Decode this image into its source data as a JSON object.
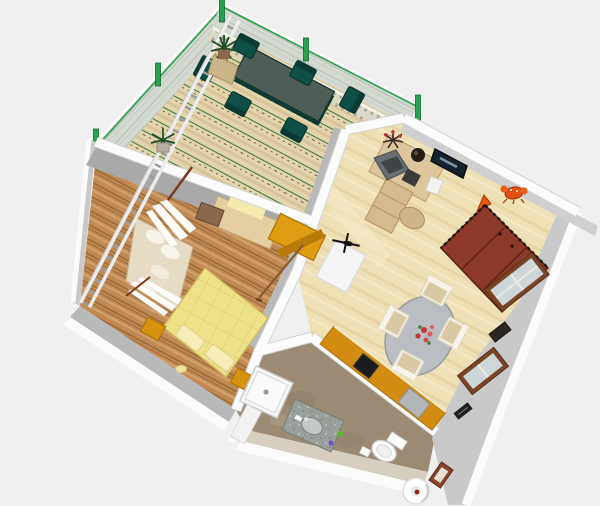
{
  "view": {
    "type": "aerial-3d-render",
    "description": "Bird's-eye 3D rendering of a furnished one-bedroom apartment with terrace, living room, bedroom, kitchen strip and bathroom"
  },
  "colors": {
    "background": "#f0f0f0",
    "wall_top": "#fbfbfb",
    "wall_edge": "#d2d2d2",
    "wall_face_light": "#c9c9c9",
    "wall_face_mid": "#b9b9b9",
    "wall_face_dark": "#a9a9a9",
    "wall_face_warm": "#d6cfc0",
    "terrace_deck": "#e4d4ab",
    "glass_railing": "#d4d9d1",
    "railing_post_green": "#28a24c",
    "balustrade": "#dcd9c8",
    "patio_table_top": "#4e5e57",
    "patio_table_edge": "#123831",
    "patio_chair": "#0e4f46",
    "living_floor": "#eee0b5",
    "bedroom_floor": "#c18a54",
    "bathroom_floor": "#9b8b74",
    "bed": "#ede289",
    "pillow": "#f6eeb6",
    "nightstand": "#d6930f",
    "dresser": "#e09c12",
    "wardrobe_red": "#8e3a28",
    "dining_table_gray": "#babdc1",
    "dining_chair_frame": "#f0ece0",
    "dining_chair_cushion": "#d9c9a2",
    "desk_wood": "#dcc79c",
    "monitor_gray": "#6a6f72",
    "tv_screen": "#16222e",
    "kitchen_counter": "#d28c12",
    "cooktop_black": "#1c1c1c",
    "appliance_gray": "#b2b6b8",
    "fridge_white": "#f5f5f5",
    "shower_white": "#fafafa",
    "sink_marble": "#9aa09c",
    "toilet_white": "#ffffff",
    "window_frame_brown": "#7a4526",
    "window_glass": "#cdd6d8",
    "vent_dark": "#2e2620",
    "toy_orange": "#e4590e",
    "crab_orange": "#e05010",
    "sofa_beige": "#e6dcc6",
    "curtain_white": "#fcfcf8",
    "curtain_rod": "#7a3a22",
    "ladder_rail": "#ececec",
    "ladder_rung": "#9c9c9c",
    "plant_green": "#1e4d22",
    "pedestal_tan": "#cbb689",
    "sideboard_tan": "#e3cf9f",
    "wall_yellow_patch": "#f4ecae",
    "broom_brown": "#8a5a30",
    "slipper_yellow": "#efe5a2",
    "picture_frame_brown": "#8a432a",
    "paper_roll_dot": "#8a2a20"
  },
  "rooms": [
    {
      "id": "terrace",
      "label": "terrace",
      "items": [
        "wood deck",
        "glass railing with green posts",
        "stone balustrade",
        "patio dining table",
        "six patio chairs",
        "two potted plants"
      ]
    },
    {
      "id": "living-room",
      "label": "living room",
      "items": [
        "red wardrobe",
        "oval dining table with flower centerpiece",
        "four upholstered chairs",
        "corner desk with monitor and keyboard",
        "wall tv",
        "toy cone",
        "toy crab",
        "fridge with toy helicopter"
      ]
    },
    {
      "id": "bedroom",
      "label": "bedroom",
      "items": [
        "double bed with pillows",
        "two nightstands",
        "daybed sofa with cushions",
        "curtains",
        "orange dresser",
        "broom",
        "slipper"
      ]
    },
    {
      "id": "kitchen",
      "label": "kitchen strip",
      "items": [
        "wood counter",
        "cooktop",
        "gray appliance"
      ]
    },
    {
      "id": "bathroom",
      "label": "bathroom",
      "items": [
        "shower tray",
        "marble sink counter",
        "toilet",
        "paper roll bin",
        "framed picture"
      ]
    }
  ],
  "exterior": {
    "items": [
      "ladder leaning on west wall",
      "windows on east wall",
      "wall vents"
    ]
  }
}
